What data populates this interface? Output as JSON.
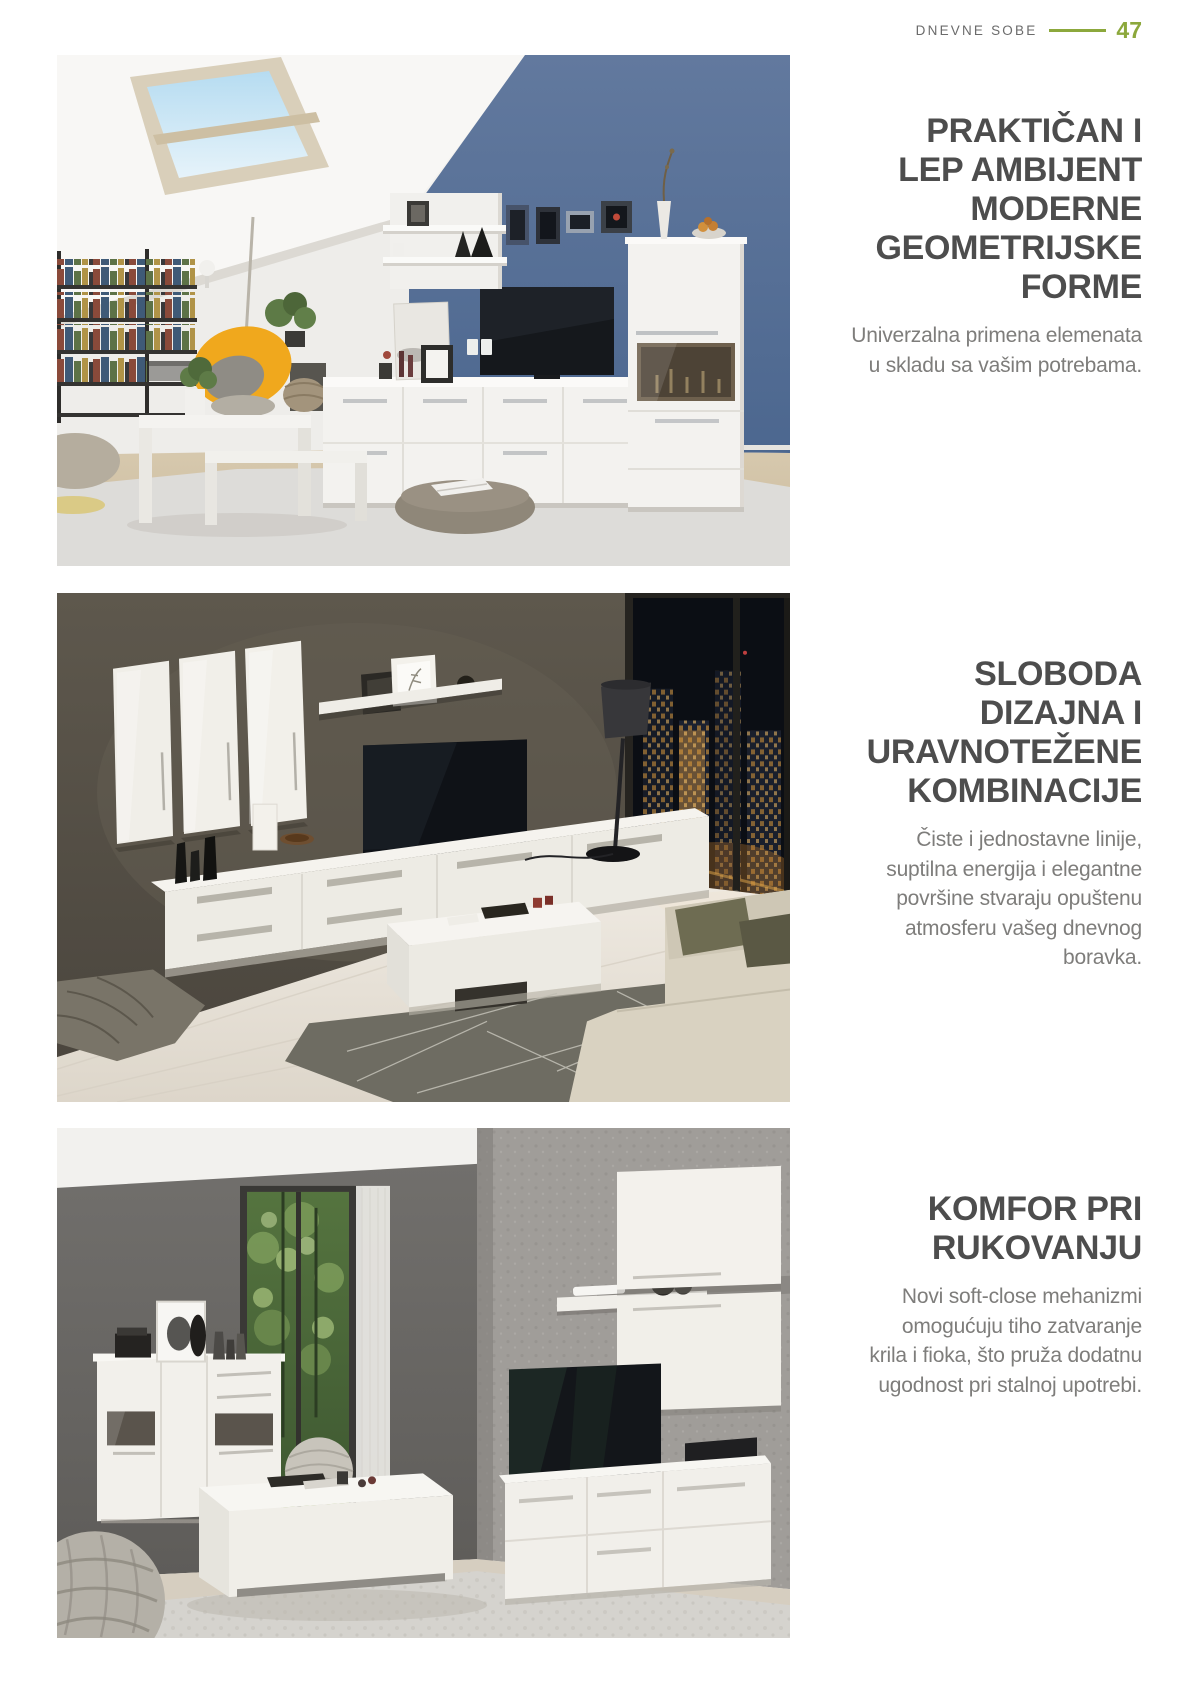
{
  "header": {
    "section_label": "DNEVNE SOBE",
    "page_number": "47"
  },
  "colors": {
    "accent_green": "#8ca83c",
    "heading_text": "#4d4d4d",
    "body_text": "#7e7d7b",
    "photo1_blue_wall": "#56719b",
    "photo2_taupe_wall": "#57524a",
    "photo3_concrete_wall": "#a09d99"
  },
  "sections": [
    {
      "heading_lines": [
        "PRAKTIČAN I",
        "LEP AMBIJENT",
        "MODERNE",
        "GEOMETRIJSKE",
        "FORME"
      ],
      "body_lines": [
        "Univerzalna primena elemenata",
        "u skladu sa vašim potrebama."
      ]
    },
    {
      "heading_lines": [
        "SLOBODA",
        "DIZAJNA I",
        "URAVNOTEŽENE",
        "KOMBINACIJE"
      ],
      "body_lines": [
        "Čiste i jednostavne linije,",
        "suptilna energija i elegantne",
        "površine stvaraju opuštenu",
        "atmosferu vašeg dnevnog",
        "boravka."
      ]
    },
    {
      "heading_lines": [
        "KOMFOR PRI",
        "RUKOVANJU"
      ],
      "body_lines": [
        "Novi soft-close mehanizmi",
        "omogućuju tiho zatvaranje",
        "krila i fioka, što pruža dodatnu",
        "ugodnost pri stalnoj upotrebi."
      ]
    }
  ]
}
